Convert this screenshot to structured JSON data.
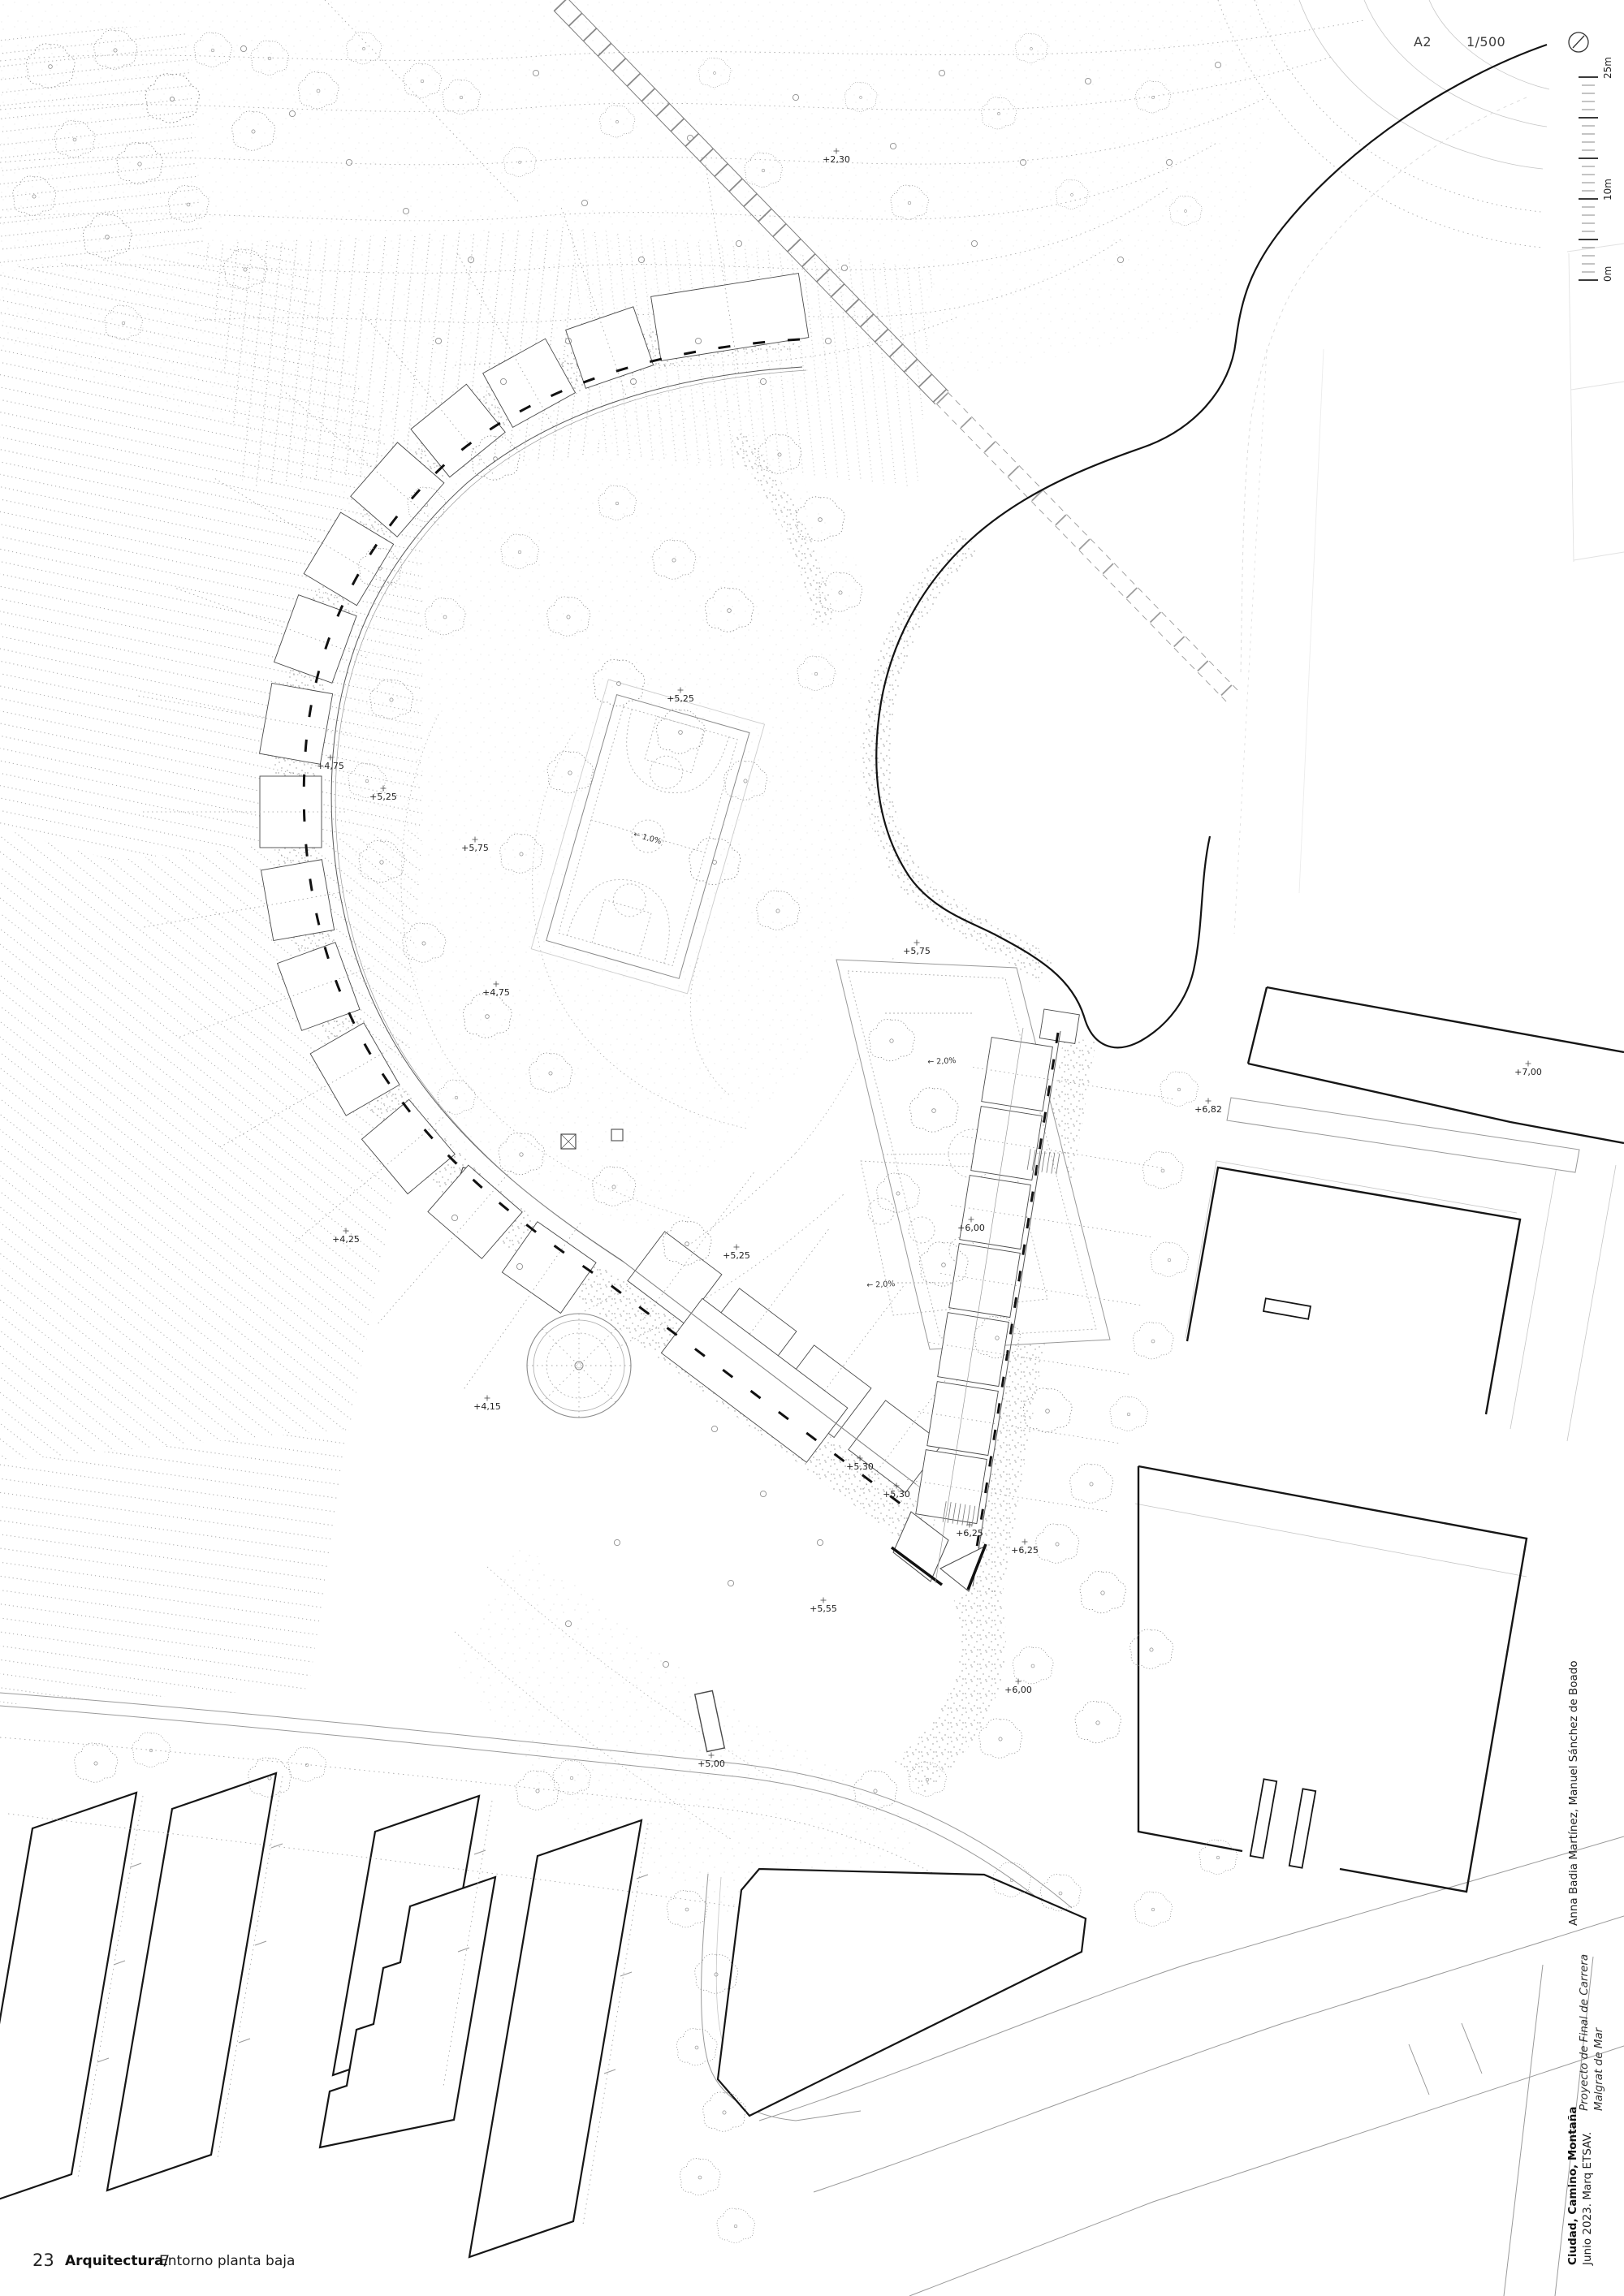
{
  "sheet": {
    "format": "A2",
    "scale": "1/500"
  },
  "scalebar": {
    "zero": "0m",
    "ten": "10m",
    "twentyfive": "25m"
  },
  "titleblock": {
    "project": "Ciudad, Camino, Montaña",
    "date": "Junio 2023. Marq ETSAV.",
    "type": "Proyecto de Final de Carrera",
    "location": "Malgrat de Mar",
    "authors": "Anna Badia Martínez, Manuel Sánchez de Boado"
  },
  "footer": {
    "page": "23",
    "section": "Arquitectura/",
    "title": "Entorno planta baja"
  },
  "plan": {
    "spot_elevations": [
      "+2,30",
      "+5,25",
      "+4,75",
      "+5,75",
      "+5,25",
      "+4,75",
      "+4,25",
      "+4,15",
      "+5,25",
      "+5,75",
      "+6,00",
      "+6,82",
      "+7,00",
      "+5,30",
      "+5,30",
      "+6,25",
      "+6,25",
      "+5,55",
      "+6,00",
      "+5,00"
    ],
    "slope_labels": [
      "← 1,0%",
      "← 2,0%",
      "← 2,0%"
    ]
  },
  "colors": {
    "ink": "#161616",
    "light_ink": "#9a9a9a",
    "paper": "#ffffff"
  }
}
